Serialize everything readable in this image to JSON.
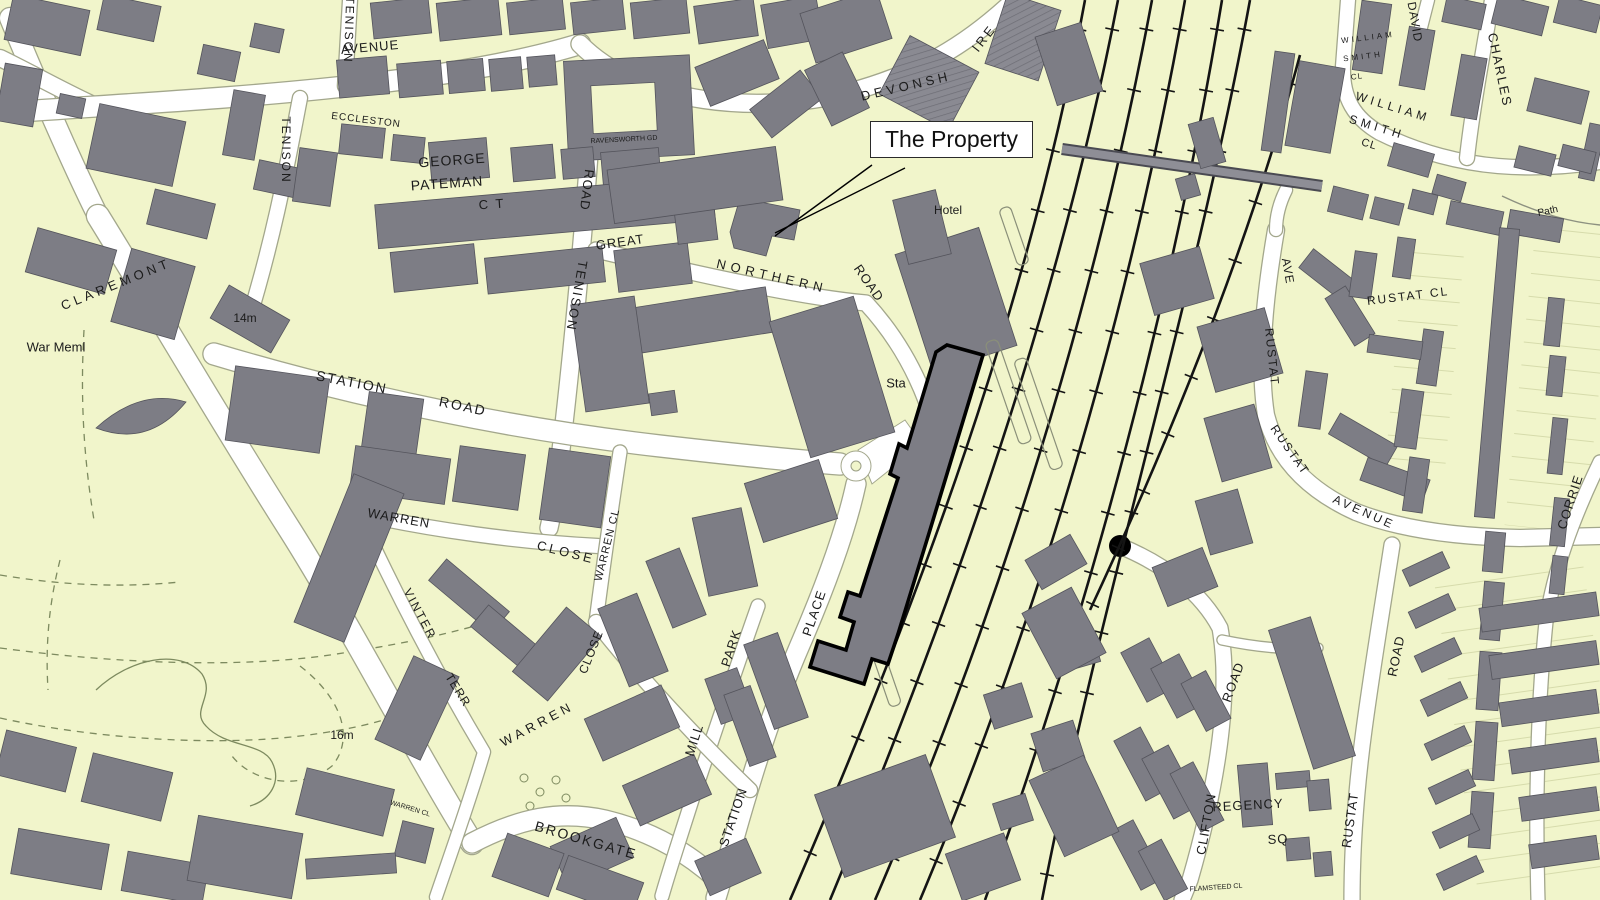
{
  "map": {
    "kind": "ordnance-survey-style street plan",
    "callout": {
      "text": "The Property",
      "x": 870,
      "y": 121
    },
    "palette": {
      "background": "#f1f5cb",
      "building": "#7d7d85",
      "building_outline": "#54545c",
      "road_fill": "#ffffff",
      "road_casing": "#a3a78c",
      "railway": "#141414",
      "bridge": "#8e8e96",
      "park_path": "#7d8a5f",
      "property_outline": "#000000",
      "label": "#1b1b1b",
      "callout_bg": "#ffffff",
      "callout_border": "#2a2a2a"
    },
    "feature_names": [
      "railway-tracks",
      "railway-footbridge",
      "station-platforms",
      "property-boundary-outline",
      "roundabout",
      "park-footpaths",
      "callout-leader-lines"
    ],
    "labels": [
      {
        "id": "tenison-ave-top",
        "text": "TENISON",
        "x": 349,
        "y": 30,
        "rotate": 92,
        "size": 12,
        "spacing": 2
      },
      {
        "id": "tenison-avenue",
        "text": "AVENUE",
        "x": 370,
        "y": 47,
        "rotate": -5,
        "size": 13,
        "spacing": 1
      },
      {
        "id": "tenison-left",
        "text": "TENISON",
        "x": 286,
        "y": 150,
        "rotate": 90,
        "size": 12,
        "spacing": 2
      },
      {
        "id": "eccleston",
        "text": "ECCLESTON",
        "x": 366,
        "y": 121,
        "rotate": 7,
        "size": 10,
        "spacing": 1
      },
      {
        "id": "george",
        "text": "GEORGE",
        "x": 452,
        "y": 160,
        "rotate": -4,
        "size": 14,
        "spacing": 1
      },
      {
        "id": "pateman",
        "text": "PATEMAN",
        "x": 447,
        "y": 183,
        "rotate": -4,
        "size": 14,
        "spacing": 1
      },
      {
        "id": "george-pateman-ct",
        "text": "C T",
        "x": 492,
        "y": 204,
        "rotate": -4,
        "size": 13,
        "spacing": 2
      },
      {
        "id": "ravensworth-gd",
        "text": "RAVENSWORTH GD",
        "x": 624,
        "y": 140,
        "rotate": -3,
        "size": 7,
        "spacing": 0
      },
      {
        "id": "tenison-road-road",
        "text": "ROAD",
        "x": 587,
        "y": 190,
        "rotate": 97,
        "size": 13,
        "spacing": 1
      },
      {
        "id": "tenison-road",
        "text": "TENISON",
        "x": 577,
        "y": 296,
        "rotate": 100,
        "size": 13,
        "spacing": 2
      },
      {
        "id": "great",
        "text": "GREAT",
        "x": 620,
        "y": 242,
        "rotate": -8,
        "size": 13,
        "spacing": 1
      },
      {
        "id": "northern",
        "text": "NORTHERN",
        "x": 772,
        "y": 276,
        "rotate": 13,
        "size": 13,
        "spacing": 5
      },
      {
        "id": "great-northern-road",
        "text": "ROAD",
        "x": 869,
        "y": 283,
        "rotate": 55,
        "size": 13,
        "spacing": 1
      },
      {
        "id": "devonshire-1",
        "text": "DEVONSH",
        "x": 906,
        "y": 86,
        "rotate": -13,
        "size": 13,
        "spacing": 4
      },
      {
        "id": "devonshire-2",
        "text": "IRE",
        "x": 984,
        "y": 38,
        "rotate": -52,
        "size": 13,
        "spacing": 3
      },
      {
        "id": "hotel",
        "text": "Hotel",
        "x": 948,
        "y": 210,
        "rotate": 0,
        "size": 12,
        "spacing": 0
      },
      {
        "id": "sta",
        "text": "Sta",
        "x": 896,
        "y": 383,
        "rotate": 0,
        "size": 13,
        "spacing": 0
      },
      {
        "id": "wm-smith-small-1",
        "text": "WILLIAM",
        "x": 1368,
        "y": 38,
        "rotate": -7,
        "size": 8,
        "spacing": 3
      },
      {
        "id": "wm-smith-small-2",
        "text": "SMITH",
        "x": 1363,
        "y": 57,
        "rotate": -7,
        "size": 8,
        "spacing": 3
      },
      {
        "id": "wm-smith-small-3",
        "text": "CL",
        "x": 1357,
        "y": 77,
        "rotate": -7,
        "size": 8,
        "spacing": 1
      },
      {
        "id": "david",
        "text": "DAVID",
        "x": 1415,
        "y": 22,
        "rotate": 80,
        "size": 12,
        "spacing": 1
      },
      {
        "id": "wm-smith-1",
        "text": "WILLIAM",
        "x": 1393,
        "y": 107,
        "rotate": 17,
        "size": 12,
        "spacing": 4
      },
      {
        "id": "wm-smith-2",
        "text": "SMITH",
        "x": 1377,
        "y": 127,
        "rotate": 17,
        "size": 12,
        "spacing": 4
      },
      {
        "id": "wm-smith-3",
        "text": "CL",
        "x": 1369,
        "y": 145,
        "rotate": 17,
        "size": 11,
        "spacing": 1
      },
      {
        "id": "charles",
        "text": "CHARLES",
        "x": 1500,
        "y": 70,
        "rotate": 78,
        "size": 13,
        "spacing": 2
      },
      {
        "id": "path",
        "text": "Path",
        "x": 1548,
        "y": 212,
        "rotate": -12,
        "size": 10,
        "spacing": 0
      },
      {
        "id": "rustat-cl",
        "text": "RUSTAT CL",
        "x": 1408,
        "y": 296,
        "rotate": -7,
        "size": 12,
        "spacing": 2
      },
      {
        "id": "rustat-ave-ave",
        "text": "AVE",
        "x": 1288,
        "y": 271,
        "rotate": 80,
        "size": 12,
        "spacing": 1
      },
      {
        "id": "rustat-ave-1",
        "text": "RUSTAT",
        "x": 1272,
        "y": 357,
        "rotate": 84,
        "size": 12,
        "spacing": 2
      },
      {
        "id": "rustat-ave-2",
        "text": "RUSTAT",
        "x": 1290,
        "y": 450,
        "rotate": 55,
        "size": 12,
        "spacing": 2
      },
      {
        "id": "rustat-ave-3",
        "text": "AVENUE",
        "x": 1364,
        "y": 512,
        "rotate": 24,
        "size": 12,
        "spacing": 3
      },
      {
        "id": "corrie",
        "text": "CORRIE",
        "x": 1570,
        "y": 502,
        "rotate": -72,
        "size": 13,
        "spacing": 1
      },
      {
        "id": "claremont",
        "text": "CLAREMONT",
        "x": 116,
        "y": 284,
        "rotate": -22,
        "size": 13,
        "spacing": 4
      },
      {
        "id": "war-meml",
        "text": "War Meml",
        "x": 56,
        "y": 347,
        "rotate": 0,
        "size": 13,
        "spacing": 0
      },
      {
        "id": "spot-14m",
        "text": "14m",
        "x": 245,
        "y": 318,
        "rotate": 0,
        "size": 12,
        "spacing": 0
      },
      {
        "id": "spot-16m",
        "text": "16m",
        "x": 342,
        "y": 735,
        "rotate": 0,
        "size": 12,
        "spacing": 0
      },
      {
        "id": "station-road-1",
        "text": "STATION",
        "x": 352,
        "y": 382,
        "rotate": 11,
        "size": 14,
        "spacing": 2
      },
      {
        "id": "station-road-2",
        "text": "ROAD",
        "x": 463,
        "y": 406,
        "rotate": 12,
        "size": 14,
        "spacing": 2
      },
      {
        "id": "warren-close-1",
        "text": "WARREN",
        "x": 399,
        "y": 518,
        "rotate": 10,
        "size": 13,
        "spacing": 1
      },
      {
        "id": "warren-close-2",
        "text": "CLOSE",
        "x": 566,
        "y": 552,
        "rotate": 14,
        "size": 13,
        "spacing": 3
      },
      {
        "id": "warren-cl-v",
        "text": "WARREN CL",
        "x": 608,
        "y": 545,
        "rotate": -76,
        "size": 11,
        "spacing": 1
      },
      {
        "id": "warren-close-v",
        "text": "CLOSE",
        "x": 591,
        "y": 652,
        "rotate": -68,
        "size": 12,
        "spacing": 1
      },
      {
        "id": "warren-close-d",
        "text": "WARREN",
        "x": 537,
        "y": 724,
        "rotate": -28,
        "size": 13,
        "spacing": 4
      },
      {
        "id": "vinter",
        "text": "VINTER",
        "x": 420,
        "y": 614,
        "rotate": 62,
        "size": 12,
        "spacing": 2
      },
      {
        "id": "terr",
        "text": "TERR",
        "x": 458,
        "y": 690,
        "rotate": 58,
        "size": 12,
        "spacing": 1
      },
      {
        "id": "brookgate",
        "text": "BROOKGATE",
        "x": 586,
        "y": 840,
        "rotate": 16,
        "size": 14,
        "spacing": 2
      },
      {
        "id": "mill",
        "text": "MILL",
        "x": 694,
        "y": 740,
        "rotate": -72,
        "size": 13,
        "spacing": 1
      },
      {
        "id": "park",
        "text": "PARK",
        "x": 731,
        "y": 648,
        "rotate": -72,
        "size": 13,
        "spacing": 1
      },
      {
        "id": "station-place-1",
        "text": "STATION",
        "x": 733,
        "y": 817,
        "rotate": -71,
        "size": 13,
        "spacing": 1
      },
      {
        "id": "station-place-2",
        "text": "PLACE",
        "x": 814,
        "y": 613,
        "rotate": -71,
        "size": 13,
        "spacing": 1
      },
      {
        "id": "clifton",
        "text": "CLIFTON",
        "x": 1206,
        "y": 824,
        "rotate": -80,
        "size": 13,
        "spacing": 1
      },
      {
        "id": "clifton-road",
        "text": "ROAD",
        "x": 1233,
        "y": 682,
        "rotate": -70,
        "size": 13,
        "spacing": 1
      },
      {
        "id": "regency",
        "text": "REGENCY",
        "x": 1248,
        "y": 805,
        "rotate": -3,
        "size": 13,
        "spacing": 1
      },
      {
        "id": "regency-sq",
        "text": "SQ",
        "x": 1278,
        "y": 839,
        "rotate": -3,
        "size": 13,
        "spacing": 1
      },
      {
        "id": "flamsteed-cl",
        "text": "FLAMSTEED CL",
        "x": 1216,
        "y": 888,
        "rotate": -4,
        "size": 7,
        "spacing": 0
      },
      {
        "id": "rustat-road-1",
        "text": "RUSTAT",
        "x": 1350,
        "y": 820,
        "rotate": -82,
        "size": 13,
        "spacing": 1
      },
      {
        "id": "rustat-road-2",
        "text": "ROAD",
        "x": 1396,
        "y": 656,
        "rotate": -78,
        "size": 13,
        "spacing": 1
      },
      {
        "id": "warren-cl-tiny",
        "text": "WARREN CL",
        "x": 410,
        "y": 809,
        "rotate": 17,
        "size": 7,
        "spacing": 0
      }
    ]
  }
}
